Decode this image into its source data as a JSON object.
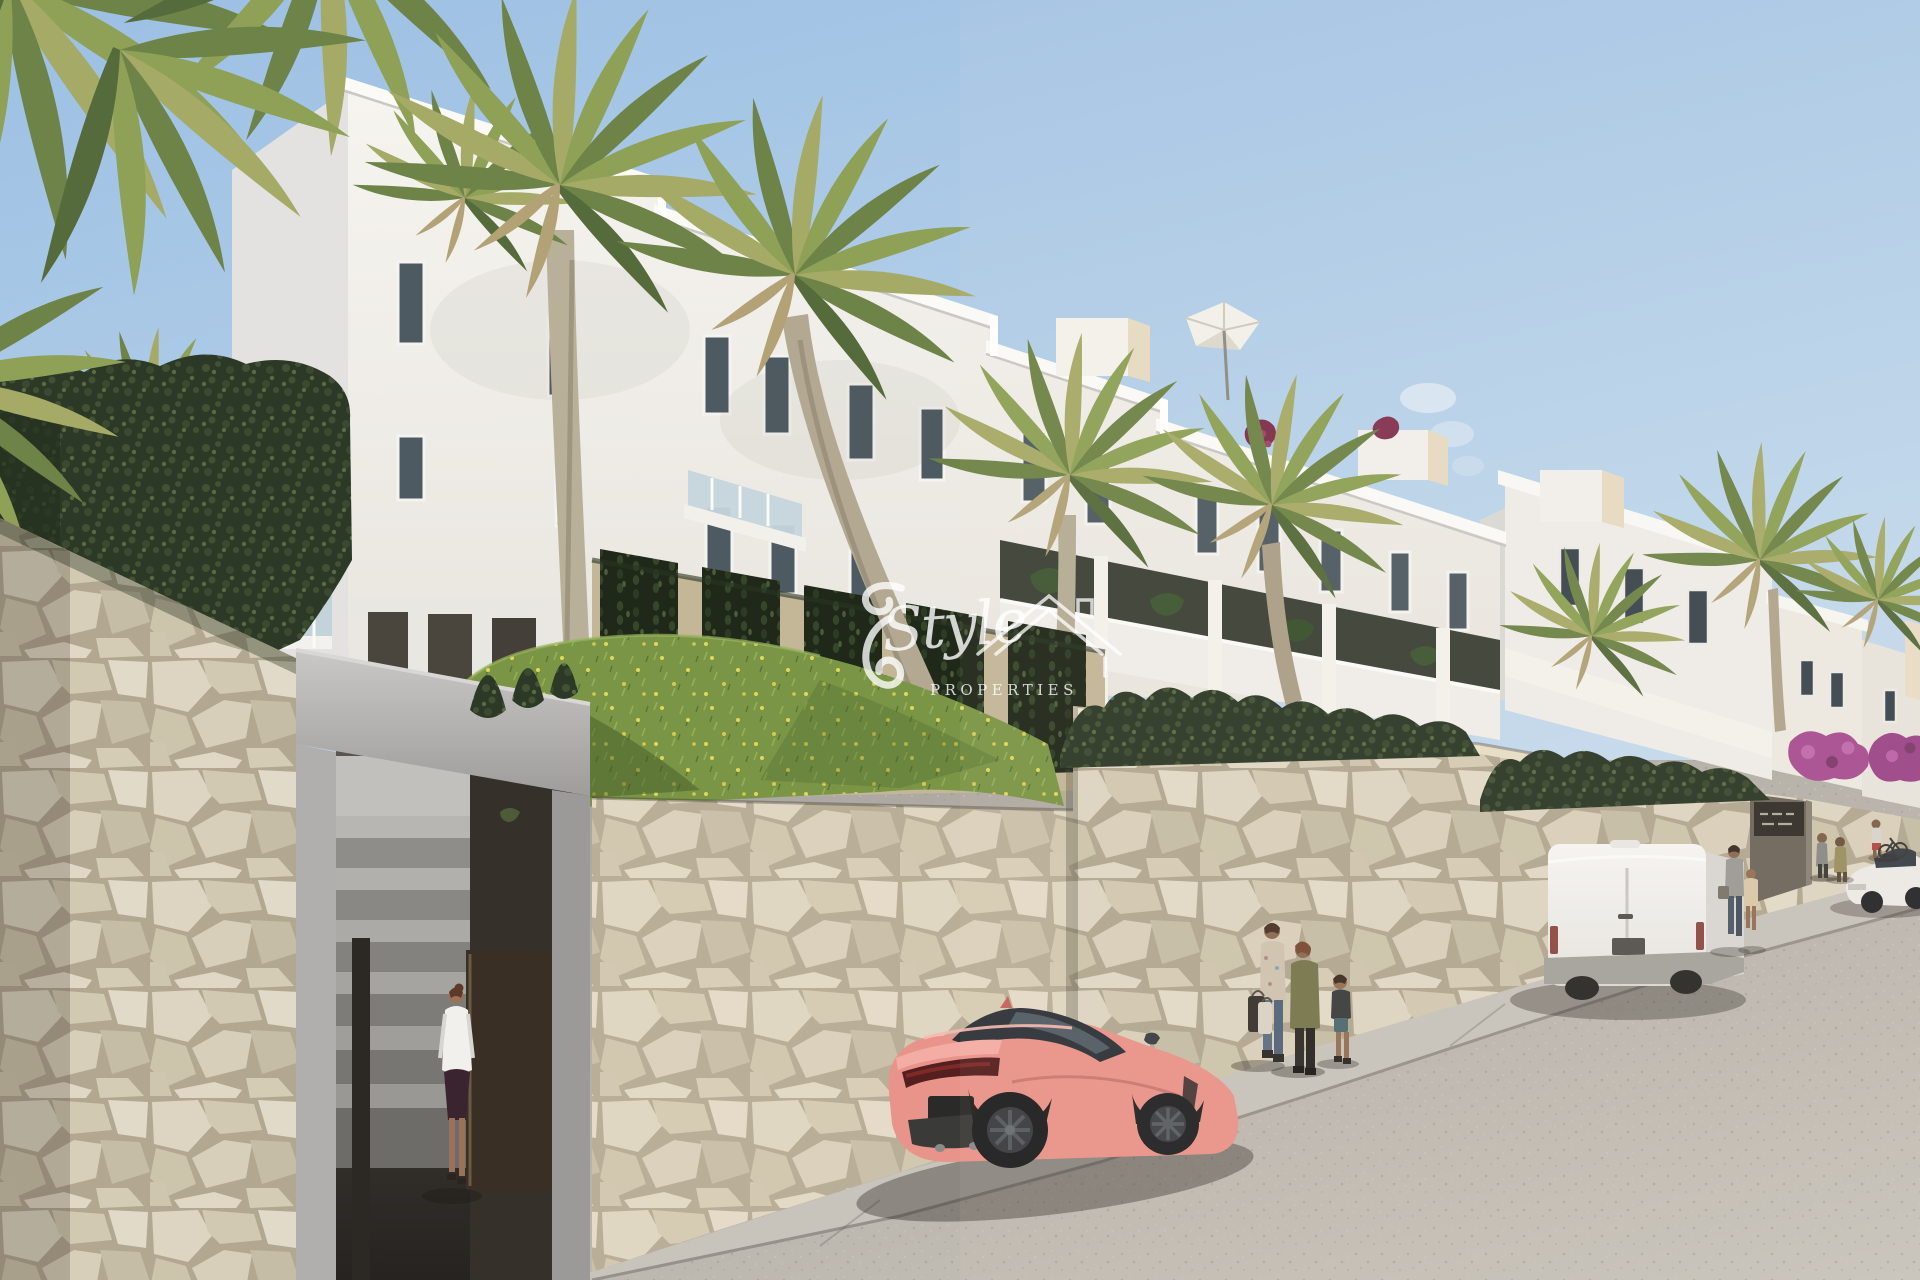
{
  "watermark": {
    "brand_script": "Style",
    "brand_caps": "PROPERTIES"
  },
  "palette": {
    "sky_top": "#9cbfe3",
    "sky_horizon": "#cfe0ee",
    "facade_sunlit": "#f4f2ed",
    "facade_shade": "#e2e1df",
    "stone_wall": "#d8d0bc",
    "stone_grout": "#b2a892",
    "concrete": "#b4b3b1",
    "door_brown": "#3a2f24",
    "grass": "#7c9746",
    "hedge_dark": "#2f3c28",
    "palm_green": "#8ea157",
    "car_pink": "#e9948b",
    "van_white": "#f3f2ef",
    "sedan_white": "#eceae6",
    "street": "#b3aea6",
    "sidewalk": "#c8c3bb",
    "bougainvillea": "#a84e92",
    "parasol_white": "#f3f1ea"
  },
  "scene": {
    "description": "New-build white apartment complex on a hillside street with palm trees, cream stone retaining walls, a grass bank with wildflowers, pedestrians, a pink sports coupe, a white van and a white sedan; real-estate watermark logo in the centre",
    "objects": [
      "apartment building with roof terraces and parasol",
      "second apartment block further up the hill",
      "fan palm trees",
      "stone retaining walls",
      "entrance stairway with open dark door and woman walking in",
      "vine-covered trellis wall",
      "grass bank with yellow wildflowers",
      "hedge rows and bougainvillea",
      "pink sports coupe parked on street",
      "white delivery van parked up the hill",
      "white sedan near upper entrance",
      "pedestrians walking on sidewalk",
      "community entrance sign on wall"
    ]
  }
}
